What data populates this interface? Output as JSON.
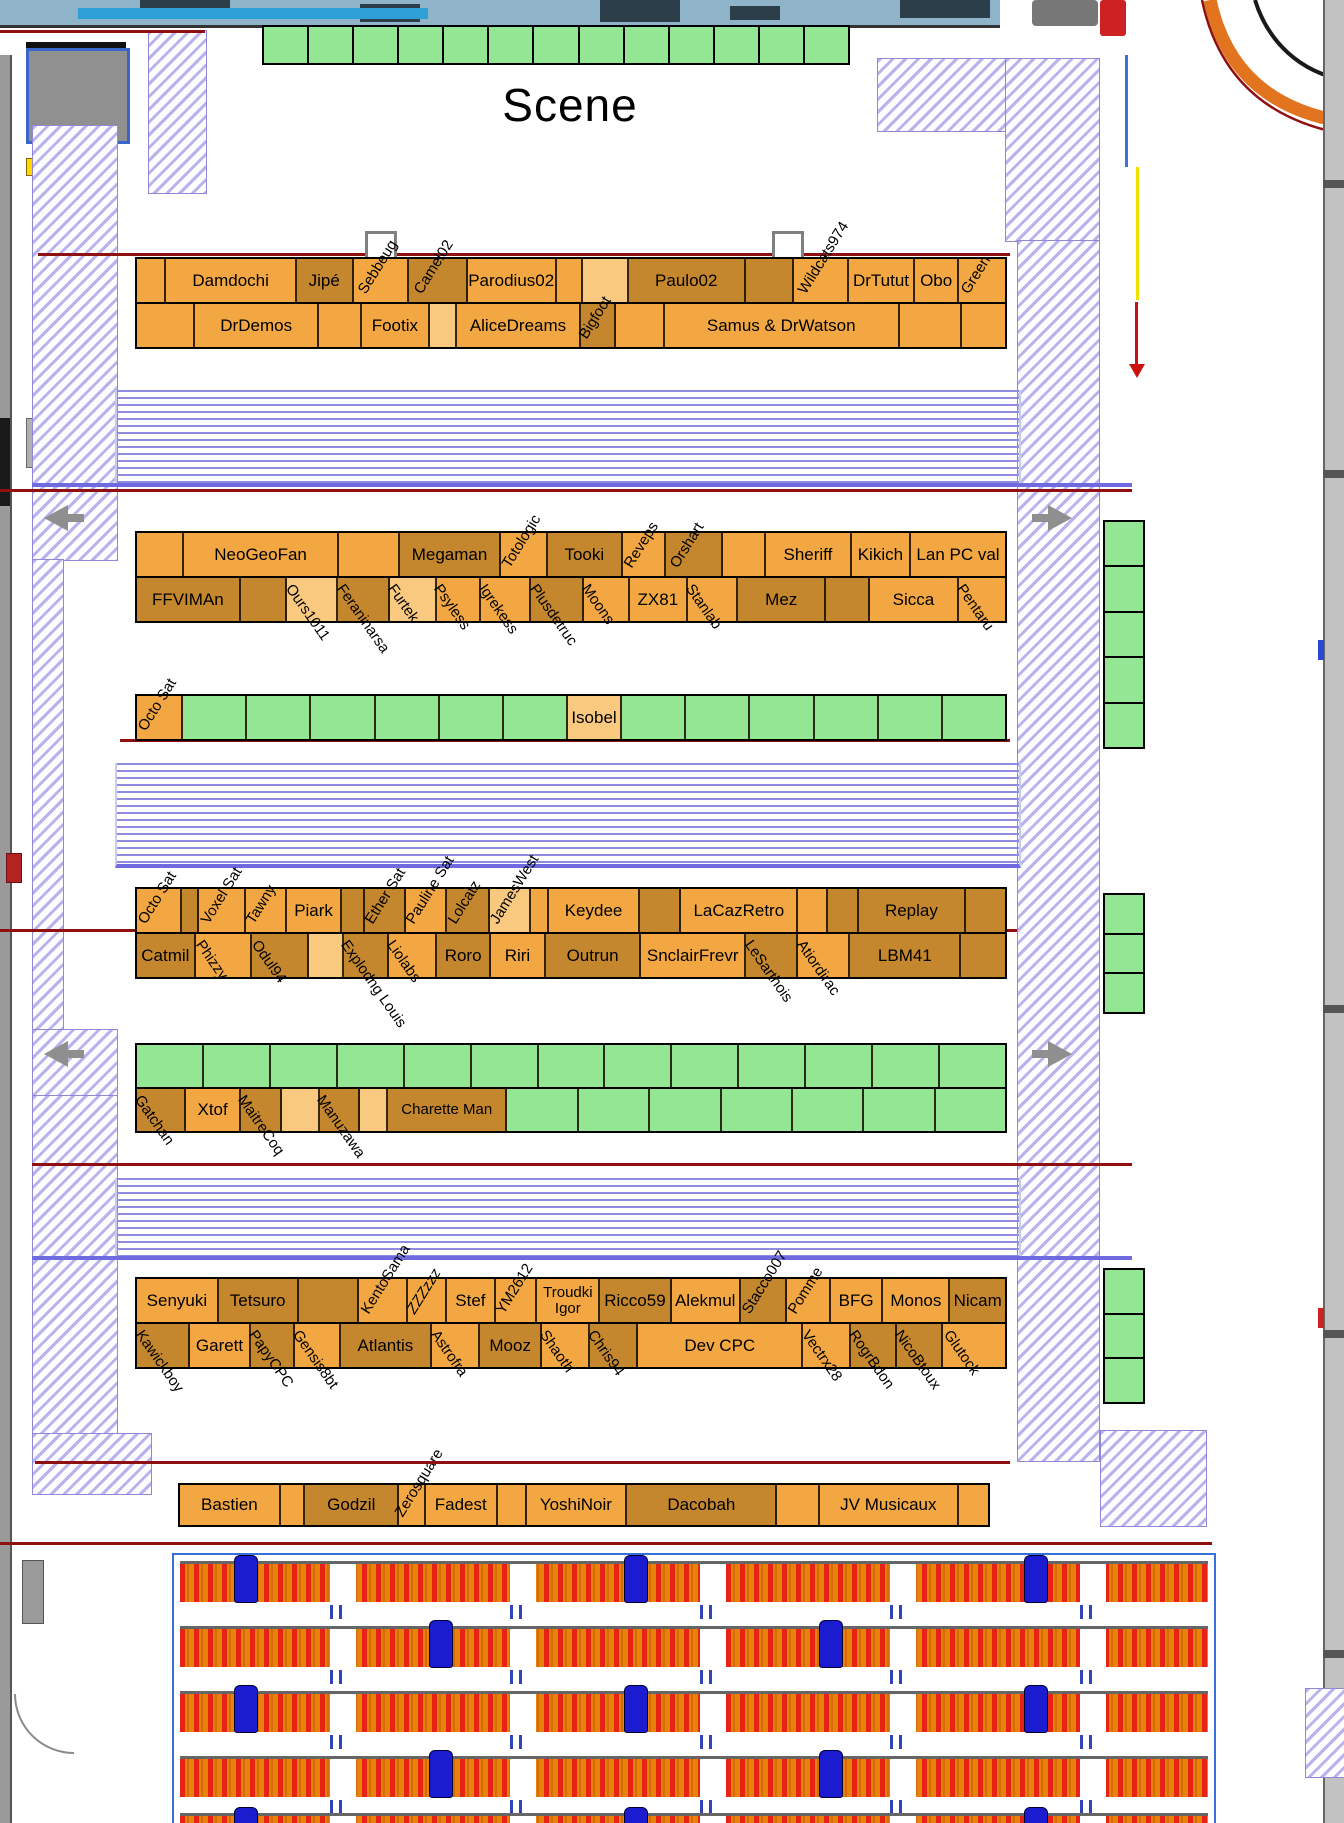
{
  "scene": {
    "label": "Scene"
  },
  "colors": {
    "seat_light": "#F2A742",
    "seat_dark": "#C4872E",
    "seat_pale": "#F8C97E",
    "table_green": "#93E693",
    "hatch_line": "#8076DC",
    "stripe_line": "#8F8BE0",
    "red_line": "#8F1010",
    "audience_orange": "#E8820A",
    "audience_seat_red": "#E62315",
    "audience_figure_blue": "#1B1BD0",
    "road_orange": "#E2731F"
  },
  "stage_row": {
    "cell_count": 13
  },
  "right_tables": [
    {
      "x": 1103,
      "y": 520,
      "w": 38,
      "h": 225,
      "cells": 5
    },
    {
      "x": 1103,
      "y": 893,
      "w": 38,
      "h": 117,
      "cells": 3
    },
    {
      "x": 1103,
      "y": 1268,
      "w": 38,
      "h": 132,
      "cells": 3
    }
  ],
  "audience": {
    "row_tops": [
      6,
      71,
      136,
      201,
      258
    ],
    "gap_lefts": [
      150,
      330,
      520,
      710,
      900
    ],
    "figure_lefts": [
      60,
      255,
      450,
      645,
      850
    ]
  },
  "blocks": [
    {
      "name": "row-1",
      "x": 135,
      "y": 257,
      "w": 872,
      "line_h": 43,
      "lines": [
        [
          {
            "w": 30
          },
          {
            "w": 140,
            "t": "Damdochi"
          },
          {
            "w": 60,
            "t": "Jipé",
            "s": "D"
          },
          {
            "w": 58,
            "t": "Sebbeug",
            "r": -1
          },
          {
            "w": 62,
            "t": "Camel02",
            "s": "D",
            "r": -1
          },
          {
            "w": 95,
            "t": "Parodius02"
          },
          {
            "w": 26
          },
          {
            "w": 48,
            "s": "P"
          },
          {
            "w": 126,
            "t": "Paulo02",
            "s": "D"
          },
          {
            "w": 50,
            "s": "D"
          },
          {
            "w": 58,
            "t": "Wildcats974",
            "r": -1
          },
          {
            "w": 70,
            "t": "DrTutut"
          },
          {
            "w": 46,
            "t": "Obo"
          },
          {
            "w": 50,
            "t": "Green",
            "r": -1
          }
        ],
        [
          {
            "w": 58
          },
          {
            "w": 125,
            "t": "DrDemos"
          },
          {
            "w": 42
          },
          {
            "w": 68,
            "t": "Footix"
          },
          {
            "w": 26,
            "s": "P"
          },
          {
            "w": 125,
            "t": "AliceDreams"
          },
          {
            "w": 34,
            "t": "Bigfoot",
            "s": "D",
            "r": -1
          },
          {
            "w": 48
          },
          {
            "w": 240,
            "t": "Samus & DrWatson"
          },
          {
            "w": 62
          },
          {
            "w": 44
          }
        ]
      ]
    },
    {
      "name": "row-2",
      "x": 135,
      "y": 531,
      "w": 872,
      "line_h": 43,
      "lines": [
        [
          {
            "w": 44
          },
          {
            "w": 150,
            "t": "NeoGeoFan"
          },
          {
            "w": 58
          },
          {
            "w": 96,
            "t": "Megaman",
            "s": "D"
          },
          {
            "w": 44,
            "t": "Totologic",
            "r": -1
          },
          {
            "w": 72,
            "t": "Tooki",
            "s": "D"
          },
          {
            "w": 40,
            "t": "Reveps",
            "r": -1
          },
          {
            "w": 54,
            "t": "Orshart",
            "s": "D",
            "r": -1
          },
          {
            "w": 40
          },
          {
            "w": 82,
            "t": "Sheriff"
          },
          {
            "w": 56,
            "t": "Kikich"
          },
          {
            "w": 92,
            "t": "Lan PC val"
          }
        ],
        [
          {
            "w": 92,
            "t": "FFVIMAn",
            "s": "D"
          },
          {
            "w": 40,
            "s": "D"
          },
          {
            "w": 44,
            "t": "Ours1011",
            "s": "P",
            "r": 1
          },
          {
            "w": 46,
            "t": "Feraninarsa",
            "s": "D",
            "r": 1
          },
          {
            "w": 40,
            "t": "Furtek",
            "s": "P",
            "r": 1
          },
          {
            "w": 38,
            "t": "Psyless",
            "r": 1
          },
          {
            "w": 44,
            "t": "Igrekess",
            "r": 1
          },
          {
            "w": 46,
            "t": "Plusdetruc",
            "s": "D",
            "r": 1
          },
          {
            "w": 40,
            "t": "Moons",
            "r": 1
          },
          {
            "w": 50,
            "t": "ZX81"
          },
          {
            "w": 44,
            "t": "Stanlab",
            "r": 1
          },
          {
            "w": 78,
            "t": "Mez",
            "s": "D"
          },
          {
            "w": 38,
            "s": "D"
          },
          {
            "w": 78,
            "t": "Sicca"
          },
          {
            "w": 42,
            "t": "Pentaru",
            "r": 1
          }
        ]
      ]
    },
    {
      "name": "green-row-1",
      "x": 135,
      "y": 694,
      "w": 872,
      "line_h": 43,
      "lines": [
        [
          {
            "w": 44,
            "t": "Octo Sat",
            "r": -1
          },
          {
            "w": 62,
            "s": "G"
          },
          {
            "w": 62,
            "s": "G"
          },
          {
            "w": 62,
            "s": "G"
          },
          {
            "w": 62,
            "s": "G"
          },
          {
            "w": 62,
            "s": "G"
          },
          {
            "w": 62,
            "s": "G"
          },
          {
            "w": 52,
            "t": "Isobel",
            "s": "P"
          },
          {
            "w": 62,
            "s": "G"
          },
          {
            "w": 62,
            "s": "G"
          },
          {
            "w": 62,
            "s": "G"
          },
          {
            "w": 62,
            "s": "G"
          },
          {
            "w": 62,
            "s": "G"
          },
          {
            "w": 62,
            "s": "G"
          }
        ]
      ]
    },
    {
      "name": "row-3",
      "x": 135,
      "y": 887,
      "w": 872,
      "line_h": 43,
      "lines": [
        [
          {
            "w": 44,
            "t": "Octo Sat",
            "r": -1
          },
          {
            "w": 16,
            "s": "D"
          },
          {
            "w": 46,
            "t": "Voxel Sat",
            "r": -1
          },
          {
            "w": 40,
            "t": "Tawny",
            "r": -1
          },
          {
            "w": 54,
            "t": "Piark"
          },
          {
            "w": 22,
            "s": "D"
          },
          {
            "w": 40,
            "t": "Ether Sat",
            "s": "D",
            "r": -1
          },
          {
            "w": 40,
            "t": "Pauline Sat",
            "r": -1
          },
          {
            "w": 42,
            "t": "Lolcatz",
            "s": "D",
            "r": -1
          },
          {
            "w": 40,
            "t": "JamesWest",
            "s": "P",
            "r": -1
          },
          {
            "w": 16
          },
          {
            "w": 92,
            "t": "Keydee"
          },
          {
            "w": 40,
            "s": "D"
          },
          {
            "w": 118,
            "t": "LaCazRetro"
          },
          {
            "w": 28
          },
          {
            "w": 30,
            "s": "D"
          },
          {
            "w": 108,
            "t": "Replay",
            "s": "D"
          },
          {
            "w": 40,
            "s": "D"
          }
        ],
        [
          {
            "w": 52,
            "t": "Catmil",
            "s": "D"
          },
          {
            "w": 50,
            "t": "Phizzy",
            "r": 1
          },
          {
            "w": 50,
            "t": "Odul94",
            "s": "D",
            "r": 1
          },
          {
            "w": 30,
            "s": "P"
          },
          {
            "w": 40,
            "t": "Explodng Louis",
            "s": "D",
            "r": 1
          },
          {
            "w": 42,
            "t": "Liolabs",
            "r": 1
          },
          {
            "w": 48,
            "t": "Roro",
            "s": "D"
          },
          {
            "w": 48,
            "t": "Riri"
          },
          {
            "w": 86,
            "t": "Outrun",
            "s": "D"
          },
          {
            "w": 94,
            "t": "SnclairFrevr"
          },
          {
            "w": 46,
            "t": "LeSarthois",
            "s": "D",
            "r": 1
          },
          {
            "w": 46,
            "t": "Atiordirac",
            "r": 1
          },
          {
            "w": 100,
            "t": "LBM41",
            "s": "D"
          },
          {
            "w": 40,
            "s": "D"
          }
        ]
      ]
    },
    {
      "name": "green-row-2",
      "x": 135,
      "y": 1043,
      "w": 872,
      "line_h": 42,
      "lines": [
        [
          {
            "w": 67,
            "s": "G"
          },
          {
            "w": 67,
            "s": "G"
          },
          {
            "w": 67,
            "s": "G"
          },
          {
            "w": 67,
            "s": "G"
          },
          {
            "w": 67,
            "s": "G"
          },
          {
            "w": 67,
            "s": "G"
          },
          {
            "w": 67,
            "s": "G"
          },
          {
            "w": 67,
            "s": "G"
          },
          {
            "w": 67,
            "s": "G"
          },
          {
            "w": 67,
            "s": "G"
          },
          {
            "w": 67,
            "s": "G"
          },
          {
            "w": 67,
            "s": "G"
          },
          {
            "w": 67,
            "s": "G"
          }
        ],
        [
          {
            "w": 44,
            "t": "Gatchan",
            "s": "D",
            "r": 1
          },
          {
            "w": 50,
            "t": "Xtof"
          },
          {
            "w": 36,
            "t": "MaitreCoq",
            "s": "D",
            "r": 1
          },
          {
            "w": 34,
            "s": "P"
          },
          {
            "w": 36,
            "t": "Manuzawa",
            "s": "D",
            "r": 1
          },
          {
            "w": 24,
            "s": "P"
          },
          {
            "w": 110,
            "t": "Charette Man",
            "s": "D",
            "two": true
          },
          {
            "w": 65,
            "s": "G"
          },
          {
            "w": 65,
            "s": "G"
          },
          {
            "w": 65,
            "s": "G"
          },
          {
            "w": 65,
            "s": "G"
          },
          {
            "w": 65,
            "s": "G"
          },
          {
            "w": 65,
            "s": "G"
          },
          {
            "w": 65,
            "s": "G"
          }
        ]
      ]
    },
    {
      "name": "row-4",
      "x": 135,
      "y": 1277,
      "w": 872,
      "line_h": 43,
      "lines": [
        [
          {
            "w": 76,
            "t": "Senyuki"
          },
          {
            "w": 74,
            "t": "Tetsuro",
            "s": "D"
          },
          {
            "w": 56,
            "s": "D"
          },
          {
            "w": 44,
            "t": "KentoSama",
            "r": -1
          },
          {
            "w": 36,
            "t": "ZZZzzz",
            "r": -1,
            "it": true
          },
          {
            "w": 44,
            "t": "Stef"
          },
          {
            "w": 38,
            "t": "YM2612",
            "r": -1
          },
          {
            "w": 58,
            "t": "Troudki Igor",
            "two": true
          },
          {
            "w": 66,
            "t": "Ricco59",
            "s": "D"
          },
          {
            "w": 64,
            "t": "Alekmul"
          },
          {
            "w": 42,
            "t": "Stacco007",
            "s": "D",
            "r": -1
          },
          {
            "w": 40,
            "t": "Pomme",
            "r": -1
          },
          {
            "w": 48,
            "t": "BFG"
          },
          {
            "w": 62,
            "t": "Monos"
          },
          {
            "w": 52,
            "t": "Nicam",
            "s": "D"
          }
        ],
        [
          {
            "w": 44,
            "t": "Kawickboy",
            "s": "D",
            "r": 1
          },
          {
            "w": 52,
            "t": "Garett"
          },
          {
            "w": 36,
            "t": "PapyCPC",
            "s": "D",
            "r": 1
          },
          {
            "w": 38,
            "t": "Gensis8bt",
            "r": 1
          },
          {
            "w": 78,
            "t": "Atlantis",
            "s": "D"
          },
          {
            "w": 40,
            "t": "Astrofra",
            "r": 1
          },
          {
            "w": 52,
            "t": "Mooz",
            "s": "D"
          },
          {
            "w": 40,
            "t": "Shaoth",
            "r": 1
          },
          {
            "w": 40,
            "t": "Chris94",
            "s": "D",
            "r": 1
          },
          {
            "w": 142,
            "t": "Dev CPC"
          },
          {
            "w": 40,
            "t": "Vectrx28",
            "r": 1
          },
          {
            "w": 38,
            "t": "RogrBdon",
            "s": "D",
            "r": 1
          },
          {
            "w": 38,
            "t": "NicoBtoux",
            "s": "D",
            "r": 1
          },
          {
            "w": 54,
            "t": "Glutock",
            "r": 1
          }
        ]
      ]
    },
    {
      "name": "row-5",
      "x": 178,
      "y": 1483,
      "w": 812,
      "line_h": 40,
      "lines": [
        [
          {
            "w": 88,
            "t": "Bastien"
          },
          {
            "w": 20
          },
          {
            "w": 82,
            "t": "Godzil",
            "s": "D"
          },
          {
            "w": 22,
            "t": "Zerosquare",
            "r": -1
          },
          {
            "w": 62,
            "t": "Fadest"
          },
          {
            "w": 24
          },
          {
            "w": 88,
            "t": "YoshiNoir"
          },
          {
            "w": 132,
            "t": "Dacobah",
            "s": "D"
          },
          {
            "w": 36
          },
          {
            "w": 122,
            "t": "JV Musicaux"
          },
          {
            "w": 26
          }
        ]
      ]
    }
  ]
}
